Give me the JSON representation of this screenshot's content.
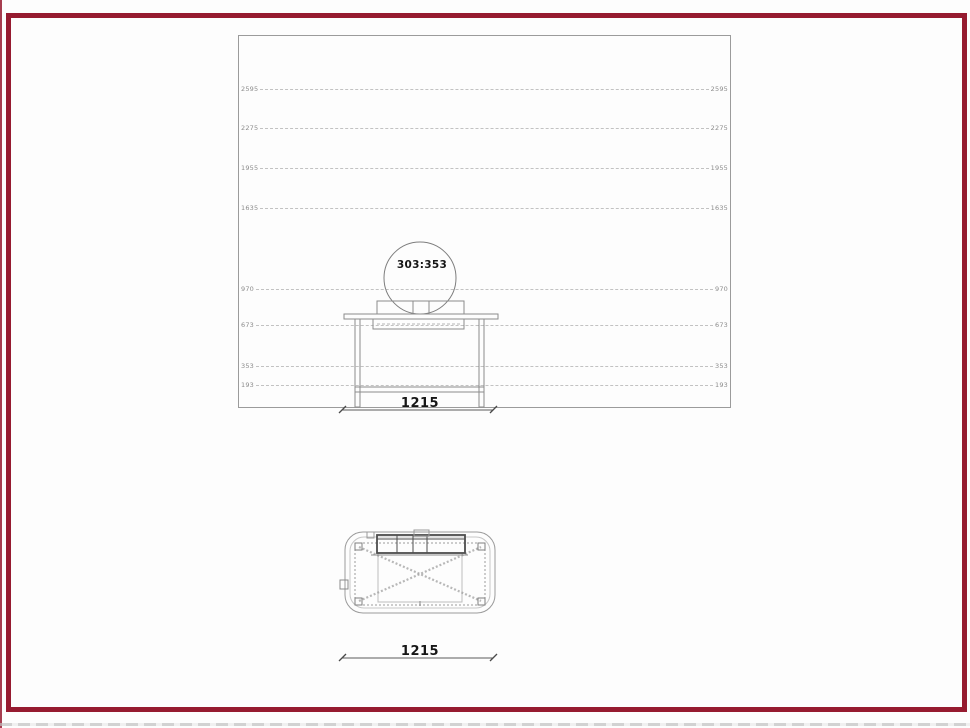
{
  "page": {
    "frame_color": "#961b30",
    "drawing_line_color": "#8c8c8c"
  },
  "elevation_view": {
    "level_labels": [
      {
        "label": "2595"
      },
      {
        "label": "2275"
      },
      {
        "label": "1955"
      },
      {
        "label": "1635"
      },
      {
        "label": "970"
      },
      {
        "label": "673"
      },
      {
        "label": "353"
      },
      {
        "label": "193"
      }
    ],
    "basin_dimension_label": "303:353",
    "width_dimension_label": "1215"
  },
  "plan_view": {
    "width_dimension_label": "1215"
  }
}
